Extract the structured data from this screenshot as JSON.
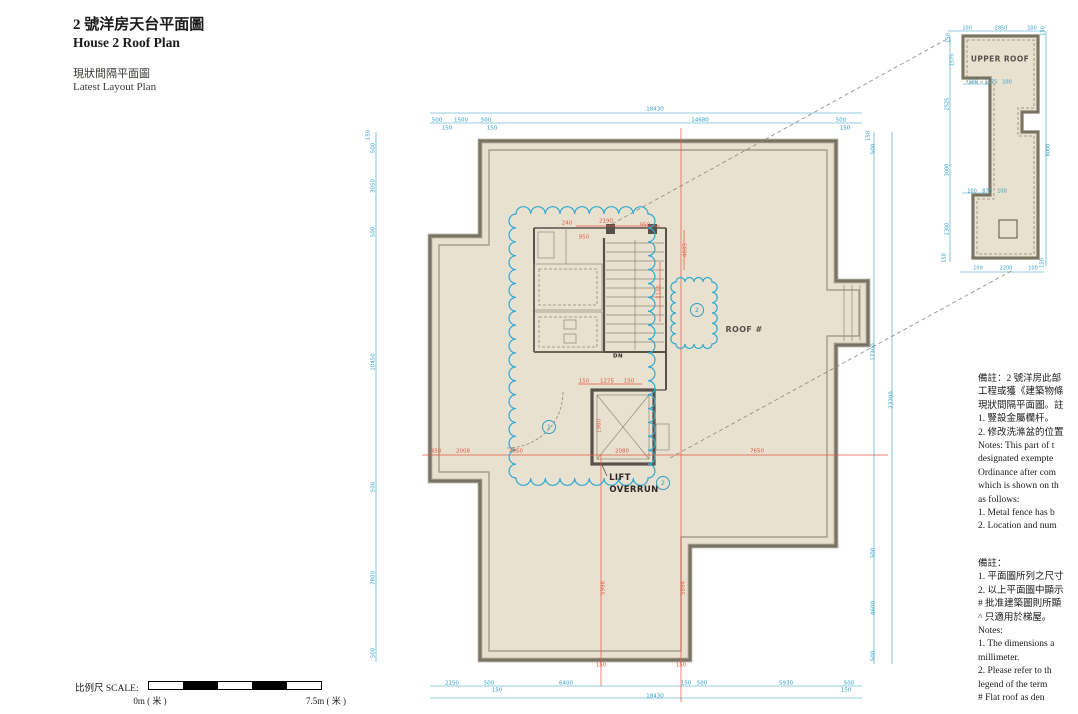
{
  "colors": {
    "paper": "#ffffff",
    "plan_fill": "#e9e1d0",
    "wall": "#97917f",
    "wall_dark": "#56524a",
    "dim_cyan": "#2f9ec4",
    "dim_red": "#e25840",
    "cloud": "#2fa9cf",
    "leader": "#8d8779",
    "ink": "#1a1a1a"
  },
  "title_block": {
    "line1_zh": "2 號洋房天台平面圖",
    "line1_en": "House 2 Roof Plan",
    "line2_zh": "現狀間隔平面圖",
    "line2_en": "Latest Layout Plan"
  },
  "scale_bar": {
    "label": "比例尺 SCALE:",
    "start": "0m ( 米 )",
    "end": "7.5m ( 米 )"
  },
  "plan_labels": [
    {
      "t": "ROOF #",
      "x": 744,
      "y": 330,
      "s": 8,
      "c": "muted"
    },
    {
      "t": "LIFT",
      "x": 620,
      "y": 478,
      "s": 8.5
    },
    {
      "t": "OVERRUN",
      "x": 634,
      "y": 490,
      "s": 8.5
    },
    {
      "t": "DN",
      "x": 618,
      "y": 357,
      "s": 5.5
    },
    {
      "t": "UPPER ROOF",
      "x": 1000,
      "y": 59,
      "s": 7.5,
      "c": "muted"
    }
  ],
  "markers": [
    {
      "n": "1",
      "x": 549,
      "y": 427
    },
    {
      "n": "2",
      "x": 663,
      "y": 483
    },
    {
      "n": "2",
      "x": 697,
      "y": 310
    }
  ],
  "dimensions": {
    "main_cyan": [
      {
        "t": "18430",
        "x": 655,
        "y": 110
      },
      {
        "t": "500",
        "x": 437,
        "y": 121
      },
      {
        "t": "1500",
        "x": 461,
        "y": 121
      },
      {
        "t": "500",
        "x": 486,
        "y": 121
      },
      {
        "t": "14680",
        "x": 700,
        "y": 121
      },
      {
        "t": "500",
        "x": 841,
        "y": 121
      },
      {
        "t": "150",
        "x": 447,
        "y": 129
      },
      {
        "t": "150",
        "x": 492,
        "y": 129
      },
      {
        "t": "150",
        "x": 845,
        "y": 129
      },
      {
        "t": "2150",
        "x": 452,
        "y": 684
      },
      {
        "t": "500",
        "x": 489,
        "y": 684
      },
      {
        "t": "150",
        "x": 497,
        "y": 691
      },
      {
        "t": "6400",
        "x": 566,
        "y": 684
      },
      {
        "t": "150",
        "x": 686,
        "y": 684
      },
      {
        "t": "500",
        "x": 702,
        "y": 684
      },
      {
        "t": "5930",
        "x": 786,
        "y": 684
      },
      {
        "t": "500",
        "x": 849,
        "y": 684
      },
      {
        "t": "150",
        "x": 846,
        "y": 691
      },
      {
        "t": "18430",
        "x": 655,
        "y": 697
      },
      {
        "t": "150",
        "x": 369,
        "y": 135,
        "r": -90
      },
      {
        "t": "500",
        "x": 374,
        "y": 148,
        "r": -90
      },
      {
        "t": "3050",
        "x": 374,
        "y": 186,
        "r": -90
      },
      {
        "t": "500",
        "x": 374,
        "y": 232,
        "r": -90
      },
      {
        "t": "10450",
        "x": 374,
        "y": 362,
        "r": -90
      },
      {
        "t": "500",
        "x": 374,
        "y": 487,
        "r": -90
      },
      {
        "t": "7800",
        "x": 374,
        "y": 578,
        "r": -90
      },
      {
        "t": "500",
        "x": 374,
        "y": 653,
        "r": -90
      },
      {
        "t": "150",
        "x": 869,
        "y": 136,
        "r": -90
      },
      {
        "t": "500",
        "x": 874,
        "y": 149,
        "r": -90
      },
      {
        "t": "17300",
        "x": 874,
        "y": 352,
        "r": -90
      },
      {
        "t": "500",
        "x": 874,
        "y": 553,
        "r": -90
      },
      {
        "t": "4600",
        "x": 874,
        "y": 608,
        "r": -90
      },
      {
        "t": "500",
        "x": 874,
        "y": 656,
        "r": -90
      },
      {
        "t": "23300",
        "x": 892,
        "y": 400,
        "r": -90
      }
    ],
    "main_red": [
      {
        "t": "240",
        "x": 567,
        "y": 224
      },
      {
        "t": "2190",
        "x": 606,
        "y": 222
      },
      {
        "t": "950",
        "x": 645,
        "y": 226
      },
      {
        "t": "950",
        "x": 584,
        "y": 238
      },
      {
        "t": "4605",
        "x": 686,
        "y": 250,
        "r": -90
      },
      {
        "t": "2125",
        "x": 660,
        "y": 292,
        "r": -90
      },
      {
        "t": "150",
        "x": 584,
        "y": 382
      },
      {
        "t": "1275",
        "x": 607,
        "y": 382
      },
      {
        "t": "150",
        "x": 629,
        "y": 382
      },
      {
        "t": "450",
        "x": 436,
        "y": 452
      },
      {
        "t": "2008",
        "x": 463,
        "y": 452
      },
      {
        "t": "4850",
        "x": 516,
        "y": 452
      },
      {
        "t": "2080",
        "x": 622,
        "y": 452
      },
      {
        "t": "7650",
        "x": 757,
        "y": 452
      },
      {
        "t": "1980",
        "x": 600,
        "y": 426,
        "r": -90
      },
      {
        "t": "5998",
        "x": 604,
        "y": 588,
        "r": -90
      },
      {
        "t": "5894",
        "x": 684,
        "y": 588,
        "r": -90
      },
      {
        "t": "150",
        "x": 601,
        "y": 666
      },
      {
        "t": "150",
        "x": 681,
        "y": 666
      }
    ],
    "detail": [
      {
        "t": "100",
        "x": 967,
        "y": 29
      },
      {
        "t": "2850",
        "x": 1001,
        "y": 29
      },
      {
        "t": "100",
        "x": 1032,
        "y": 29
      },
      {
        "t": "150",
        "x": 949,
        "y": 38,
        "r": -90
      },
      {
        "t": "150",
        "x": 1044,
        "y": 31,
        "r": -90
      },
      {
        "t": "1575",
        "x": 953,
        "y": 60,
        "r": -90
      },
      {
        "t": "100",
        "x": 973,
        "y": 83
      },
      {
        "t": "1175",
        "x": 991,
        "y": 83
      },
      {
        "t": "100",
        "x": 1007,
        "y": 83
      },
      {
        "t": "2525",
        "x": 948,
        "y": 104,
        "r": -90
      },
      {
        "t": "3000",
        "x": 948,
        "y": 170,
        "r": -90
      },
      {
        "t": "100",
        "x": 972,
        "y": 192
      },
      {
        "t": "875",
        "x": 987,
        "y": 192
      },
      {
        "t": "100",
        "x": 1002,
        "y": 192
      },
      {
        "t": "2300",
        "x": 948,
        "y": 229,
        "r": -90
      },
      {
        "t": "100",
        "x": 978,
        "y": 269
      },
      {
        "t": "2200",
        "x": 1006,
        "y": 269
      },
      {
        "t": "100",
        "x": 1033,
        "y": 269
      },
      {
        "t": "150",
        "x": 945,
        "y": 258,
        "r": -90
      },
      {
        "t": "150",
        "x": 1043,
        "y": 263,
        "r": -90
      },
      {
        "t": "8000",
        "x": 1049,
        "y": 150,
        "r": -90
      }
    ]
  },
  "notes_block1": {
    "lines": [
      "備註：2 號洋房此部",
      "工程或獲《建築物條",
      "現狀間隔平面圖。註",
      "1.  豎設金屬欄杆。",
      "2.  修改洗滌盆的位置",
      "Notes: This part of t",
      "designated exempte",
      "Ordinance after com",
      "which is shown on th",
      "as follows:",
      "1.  Metal fence has b",
      "2.  Location and num"
    ]
  },
  "notes_block2": {
    "lines": [
      "備註：",
      "1.  平面圖所列之尺寸",
      "2.  以上平面圖中顯示",
      "#   批准建築圖則所顯",
      "^   只適用於梯屋。",
      "Notes:",
      "1.  The dimensions a",
      "     millimeter.",
      "2.  Please refer to th",
      "     legend of the term",
      "#   Flat roof as den"
    ]
  }
}
